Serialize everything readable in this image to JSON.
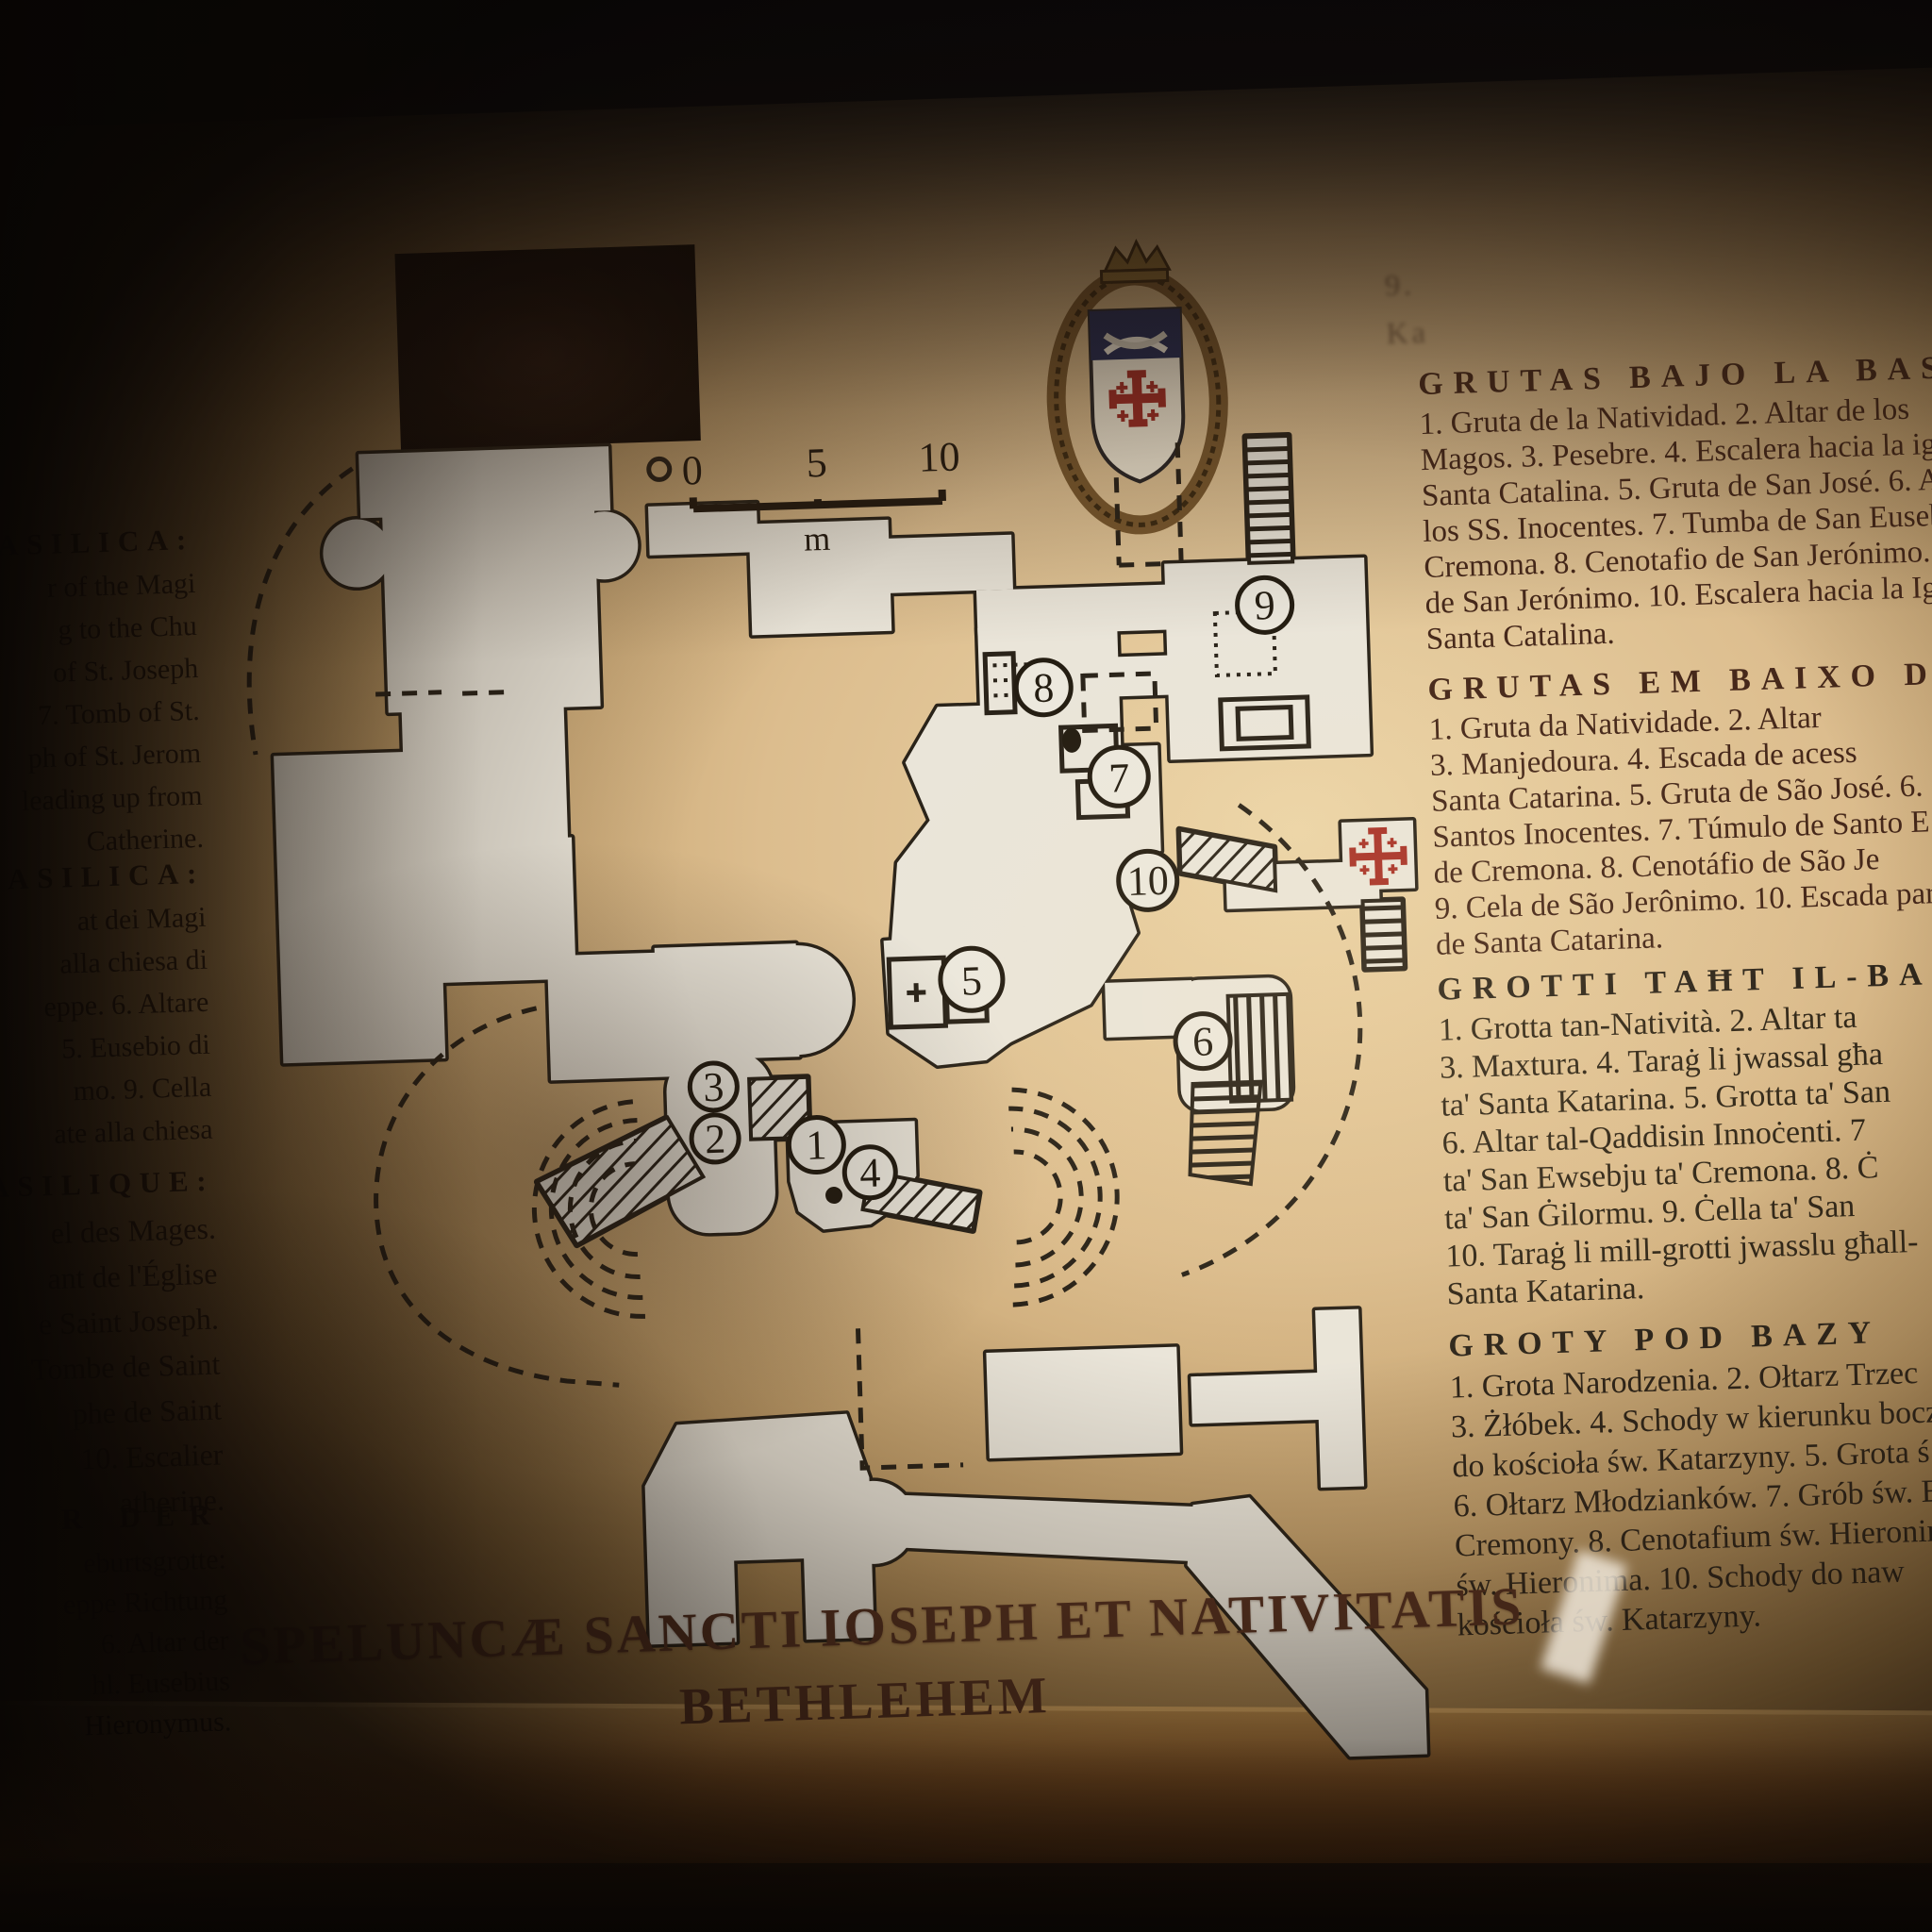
{
  "colors": {
    "board_tan": "#dcbd8e",
    "room_fill": "#eae5d9",
    "map_line": "#2a2319",
    "legend_text": "#46281a",
    "title_color": "#54301f",
    "jerusalem_cross_red": "#a33028"
  },
  "title": {
    "line1": "SPELUNCÆ SANCTI IOSEPH ET NATIVITATIS",
    "line2": "BETHLEHEM"
  },
  "scale_bar": {
    "tick_0": "0",
    "tick_5": "5",
    "tick_10": "10",
    "unit": "m"
  },
  "map": {
    "numbers": [
      "1",
      "2",
      "3",
      "4",
      "5",
      "6",
      "7",
      "8",
      "9",
      "10"
    ]
  },
  "right_column": {
    "top_fragments": [
      "9.",
      "Ka"
    ],
    "spanish": {
      "heading": "GRUTAS BAJO LA BASÍ",
      "lines": [
        "1. Gruta de la Natividad. 2. Altar de los",
        "Magos. 3. Pesebre. 4. Escalera hacia la igl",
        "Santa Catalina. 5. Gruta de San José. 6. Al",
        "los SS. Inocentes. 7. Tumba de San Euseb",
        "Cremona. 8. Cenotafio de San Jerónimo. 9.",
        "de San Jerónimo. 10. Escalera hacia la Igl",
        "Santa Catalina."
      ]
    },
    "portuguese": {
      "heading": "GRUTAS EM BAIXO DA BAS",
      "lines": [
        "1. Gruta da Natividade. 2. Altar",
        "3. Manjedoura. 4. Escada de acess",
        "Santa Catarina. 5. Gruta de São José. 6.",
        "Santos Inocentes. 7. Túmulo de Santo E",
        "de Cremona. 8. Cenotáfio de São Je",
        "9. Cela de São Jerônimo. 10. Escada para",
        "de Santa Catarina."
      ]
    },
    "maltese": {
      "heading": "GROTTI TAĦT IL-BAŻI",
      "lines": [
        "1. Grotta tan-Natività. 2. Altar ta",
        "3. Maxtura. 4. Taraġ li jwassal għa",
        "ta' Santa Katarina. 5. Grotta ta' San",
        "6. Altar tal-Qaddisin Innoċenti. 7",
        "ta' San Ewsebju ta' Cremona. 8. Ċ",
        "ta' San Ġilormu. 9. Ċella ta' San",
        "10. Taraġ li mill-grotti jwasslu għall-",
        "Santa Katarina."
      ]
    },
    "polish": {
      "heading": "GROTY POD BAZY",
      "lines": [
        "1. Grota Narodzenia. 2. Ołtarz Trzec",
        "3. Żłóbek. 4. Schody w kierunku boczne",
        "do kościoła św. Katarzyny. 5. Grota ś",
        "6. Ołtarz Młodzianków. 7. Grób św. Eu",
        "Cremony. 8. Cenotafium św. Hieronim",
        "św. Hieronima. 10. Schody do naw",
        "kościoła św. Katarzyny."
      ]
    }
  },
  "left_column": {
    "english": {
      "heading": "E BASILICA:",
      "lines": [
        "r of the Magi",
        "g to the Chu",
        "of St. Joseph",
        "7. Tomb of St.",
        "ph of St. Jerom",
        "leading up from",
        "Catherine."
      ]
    },
    "italian": {
      "heading": "BASILICA:",
      "lines": [
        "at dei Magi",
        "alla chiesa di",
        "eppe. 6. Altare",
        "5. Eusebio di",
        "mo. 9. Cella",
        "ate alla chiesa"
      ]
    },
    "french": {
      "heading": "ASILIQUE:",
      "lines": [
        "el des Mages.",
        "ant de l'Église",
        "e Saint Joseph.",
        "Tombe de Saint",
        "phe de Saint",
        "10. Escalier",
        "atherine."
      ]
    },
    "german": {
      "heading": "R DER",
      "lines": [
        "eburtsgrotte:",
        "eppe Richtung",
        "6. Altar der",
        "hl. Eusebius",
        "Hieronymus."
      ]
    }
  }
}
